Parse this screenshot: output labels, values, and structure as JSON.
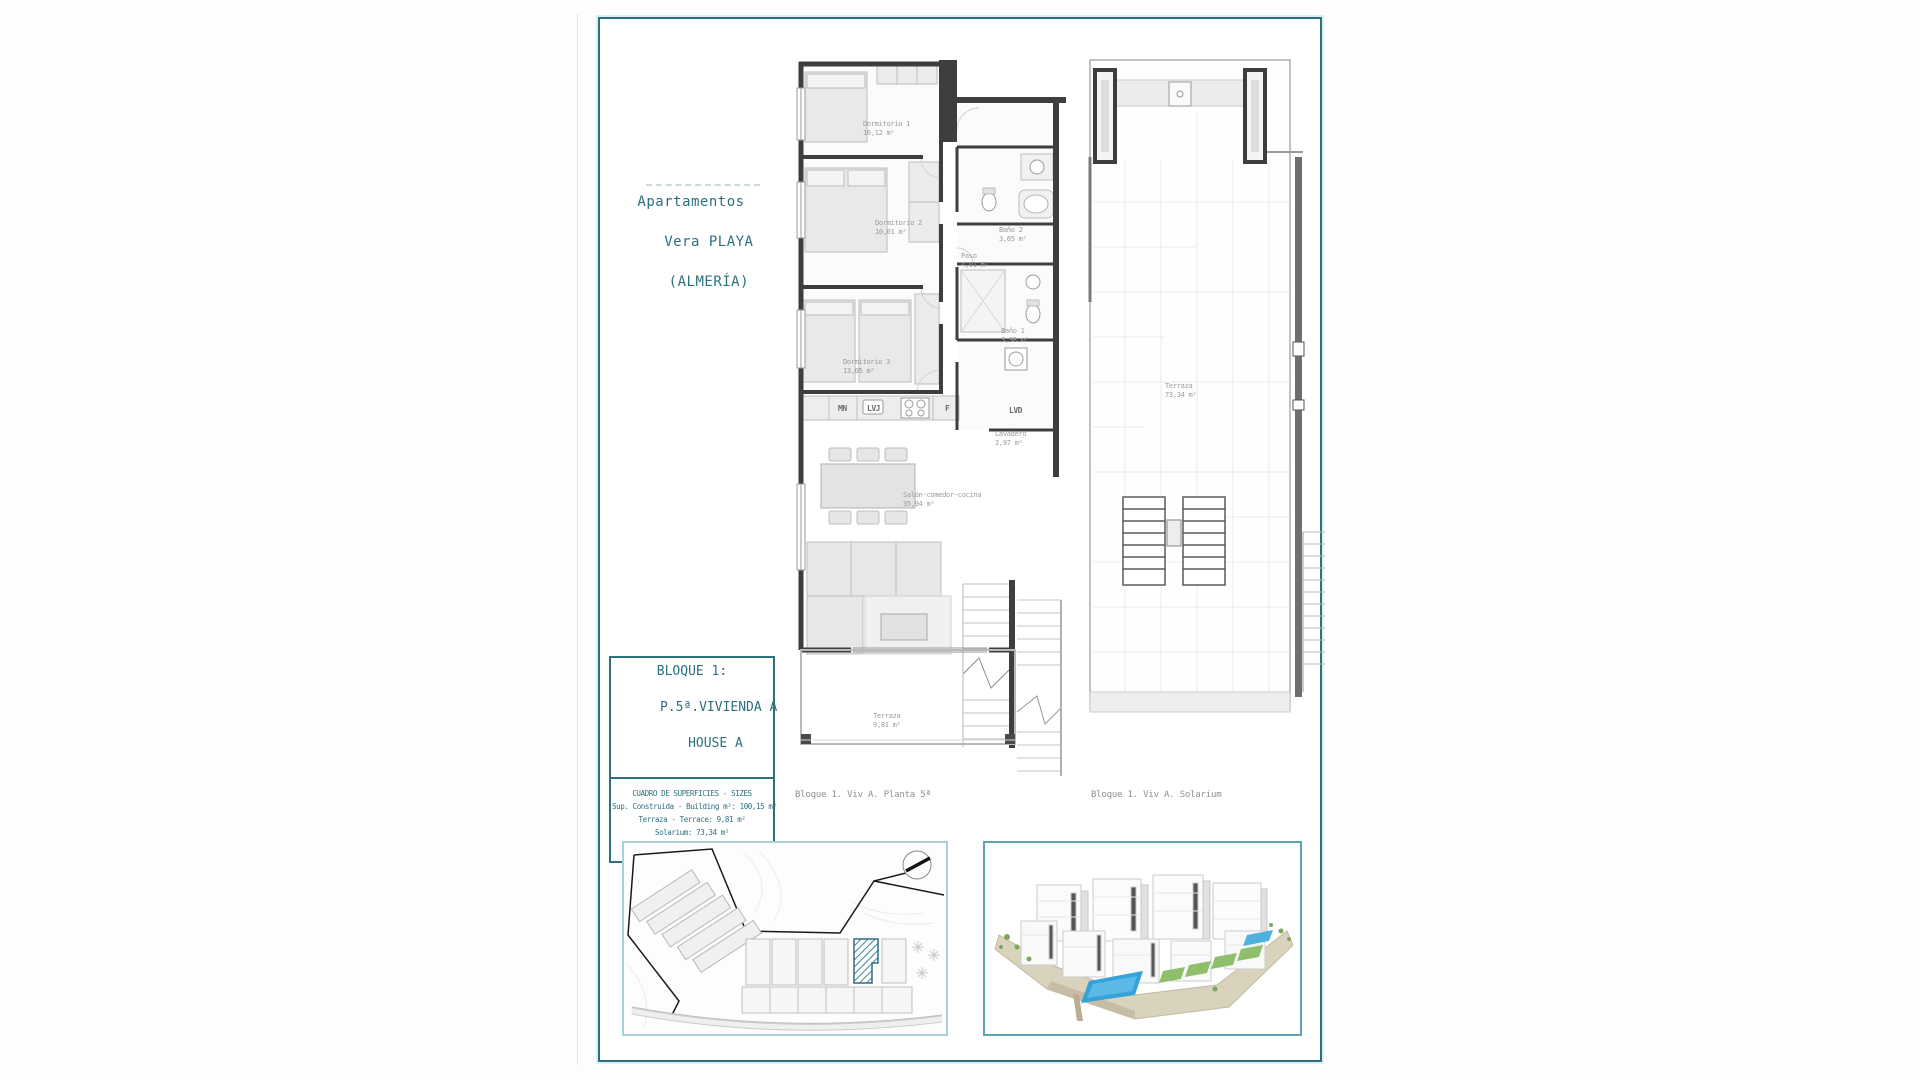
{
  "document": {
    "project_title_lines": [
      "Apartamentos",
      "Vera PLAYA",
      "(ALMERÍA)"
    ],
    "unit_box": {
      "line1": "BLOQUE 1:",
      "line2": "P.5ª.VIVIENDA A",
      "line3": "HOUSE A",
      "table_heading": "CUADRO DE SUPERFICIES  - SIZES",
      "row_built": "Sup. Construida - Building m²: 100,15 m²",
      "row_terrace": "Terraza - Terrace: 9,81 m²",
      "row_solarium": "Solarium: 73,34 m²",
      "row_total": "TOTAL: 183,30 m²"
    },
    "floor_plan": {
      "caption": "Bloque 1. Viv A. Planta 5ª",
      "rooms": [
        {
          "name": "Dormitorio 1",
          "area": "16,12 m²"
        },
        {
          "name": "Dormitorio 2",
          "area": "10,01 m²"
        },
        {
          "name": "Baño 2",
          "area": "3,65 m²"
        },
        {
          "name": "Paso",
          "area": "4,01 m²"
        },
        {
          "name": "Baño 1",
          "area": "3,98 m²"
        },
        {
          "name": "Dormitorio 3",
          "area": "13,05 m²"
        },
        {
          "name": "Lavadero",
          "area": "2,97 m²"
        },
        {
          "name": "Salón-comedor-cocina",
          "area": "35,94 m²"
        },
        {
          "name": "Terraza",
          "area": "9,81 m²"
        }
      ],
      "appliances": {
        "mn": "MN",
        "lvj": "LVJ",
        "f": "F",
        "lvd": "LVD"
      }
    },
    "solarium_plan": {
      "caption": "Bloque 1. Viv A. Solarium",
      "room": {
        "name": "Terraza",
        "area": "73,34 m²"
      }
    }
  },
  "icons": {
    "compass": "compass-circle-with-north-needle",
    "palm_tree": "asterisk-star-symbol",
    "highlighted_unit": "diagonal-hatched-parcel",
    "stairs": "parallel-tread-lines"
  },
  "colors": {
    "page_border": "#2e6f80",
    "page_border_glow": "#dff0f4",
    "title_teal": "#2d7080",
    "plan_wall": "#3e3e3e",
    "label_gray": "#9b9b9b",
    "caption_gray": "#8f8f8f",
    "site_border": "#a9d0d7",
    "render_border": "#5ba4b4",
    "highlight_hatch": "#4a93a5",
    "pool_blue": "#35a3d9",
    "lawn_green": "#8fbf6a",
    "ground_tan": "#d9d2bd"
  }
}
